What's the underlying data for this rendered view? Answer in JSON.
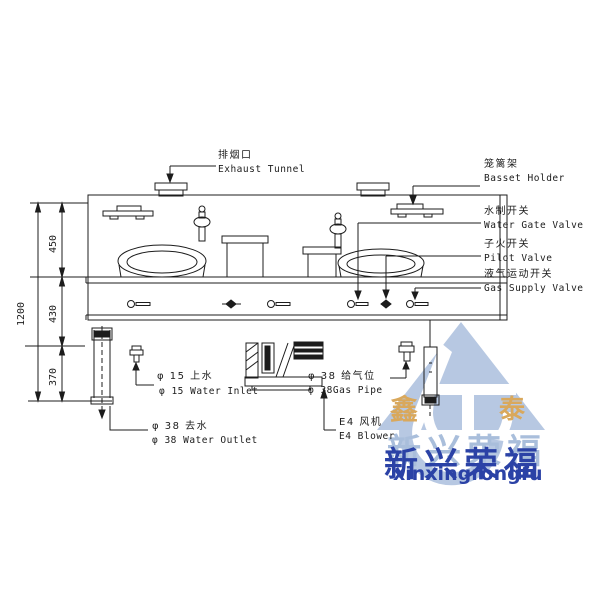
{
  "dimensions": {
    "total": "1200",
    "upper": "450",
    "middle": "430",
    "lower": "370"
  },
  "callouts": {
    "exhaust_tunnel": {
      "cn": "排烟口",
      "en": "Exhaust Tunnel"
    },
    "basket_holder": {
      "cn": "笼篱架",
      "en": "Basset Holder"
    },
    "water_gate_valve": {
      "cn": "水制开关",
      "en": "Water Gate Valve"
    },
    "pilot_valve": {
      "cn": "子火开关",
      "en": "Pilot Valve"
    },
    "gas_supply_valve": {
      "cn": "液气运动开关",
      "en": "Gas Supply Valve"
    },
    "water_inlet": {
      "cn": "φ 15 上水",
      "en": "φ 15 Water Inlet"
    },
    "gas_pipe": {
      "cn": "φ 38 给气位",
      "en": "φ 38Gas Pipe"
    },
    "water_outlet": {
      "cn": "φ 38 去水",
      "en": "φ 38 Water Outlet"
    },
    "blower": {
      "cn": "E4 风机",
      "en": "E4 Blower"
    }
  },
  "watermark": {
    "seal_left": "鑫",
    "seal_right": "泰",
    "brand_cn": "新兴荣福",
    "brand_en": "xinxingrongfu",
    "colors": {
      "logo_blue": "#b4c6e1",
      "brand_blue": "#2b42a6",
      "brand_light": "#a9bedb",
      "gold": "#d9a85c"
    }
  },
  "line_color": "#1c1c1c"
}
